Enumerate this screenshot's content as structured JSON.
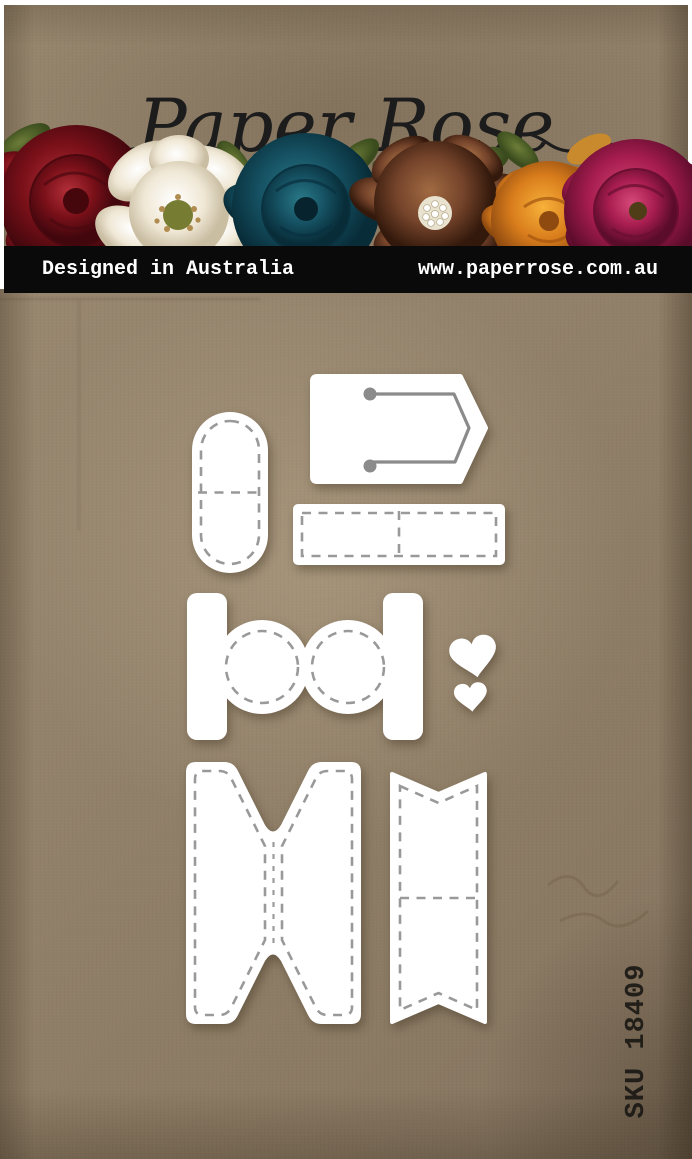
{
  "header": {
    "brand_script": "Paper Rose",
    "bar": {
      "designed_in": "Designed in Australia",
      "website": "www.paperrose.com.au",
      "bg": "#0a0a0a",
      "text_color": "#ffffff"
    }
  },
  "flowers": [
    {
      "name": "dark-red-rose",
      "color": "#7a1019"
    },
    {
      "name": "white-magnolia",
      "color": "#f2ecdf"
    },
    {
      "name": "teal-rose",
      "color": "#155061"
    },
    {
      "name": "brown-jewel-flower",
      "color": "#74432a"
    },
    {
      "name": "orange-flower",
      "color": "#d97d1c"
    },
    {
      "name": "magenta-peony",
      "color": "#a81d4f"
    }
  ],
  "product": {
    "sku": "SKU 18409",
    "die_color": "#ffffff",
    "stitch_color": "#999999",
    "string_line_color": "#8b8b8b",
    "dies": [
      {
        "name": "pill-tab-die"
      },
      {
        "name": "arrow-tag-die"
      },
      {
        "name": "rectangle-label-die"
      },
      {
        "name": "spool-circles-die"
      },
      {
        "name": "heart-large-die"
      },
      {
        "name": "heart-small-die"
      },
      {
        "name": "spool-wrap-die"
      },
      {
        "name": "fishtail-banner-die"
      }
    ]
  },
  "background": {
    "base": "#94836c"
  }
}
